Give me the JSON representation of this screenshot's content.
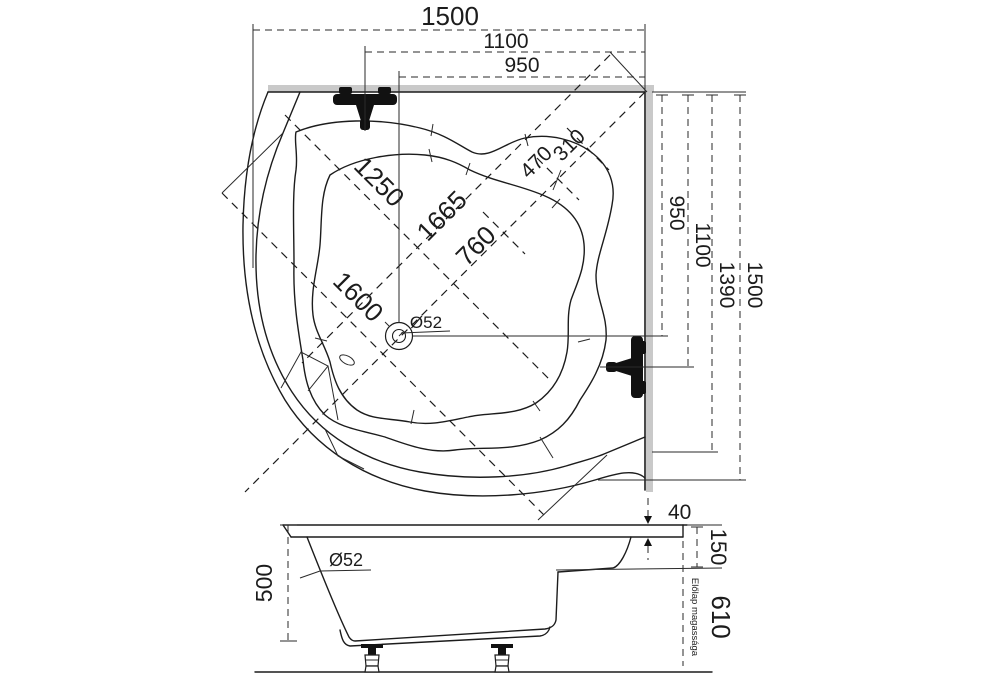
{
  "title": "Corner bathtub technical drawing",
  "plan": {
    "dim_width_total": "1500",
    "dim_width_faucet": "1100",
    "dim_width_drain": "950",
    "dim_height_drain": "950",
    "dim_height_faucet": "1100",
    "dim_height_rim": "1390",
    "dim_height_total": "1500",
    "dim_diag_basin": "1250",
    "dim_diag_axis": "1665",
    "dim_diag_seat": "760",
    "dim_front_edge": "1600",
    "dim_corner_outer": "470",
    "dim_corner_inner": "310",
    "drain_label": "Ø52"
  },
  "section": {
    "dim_rim_thickness": "40",
    "dim_rim_drop": "150",
    "dim_depth": "500",
    "dim_panel_height": "610",
    "panel_note": "Előlap magassága",
    "drain_label": "Ø52"
  },
  "colors": {
    "line": "#1c1c1c",
    "wall": "#c9c9c9",
    "background": "#ffffff"
  }
}
